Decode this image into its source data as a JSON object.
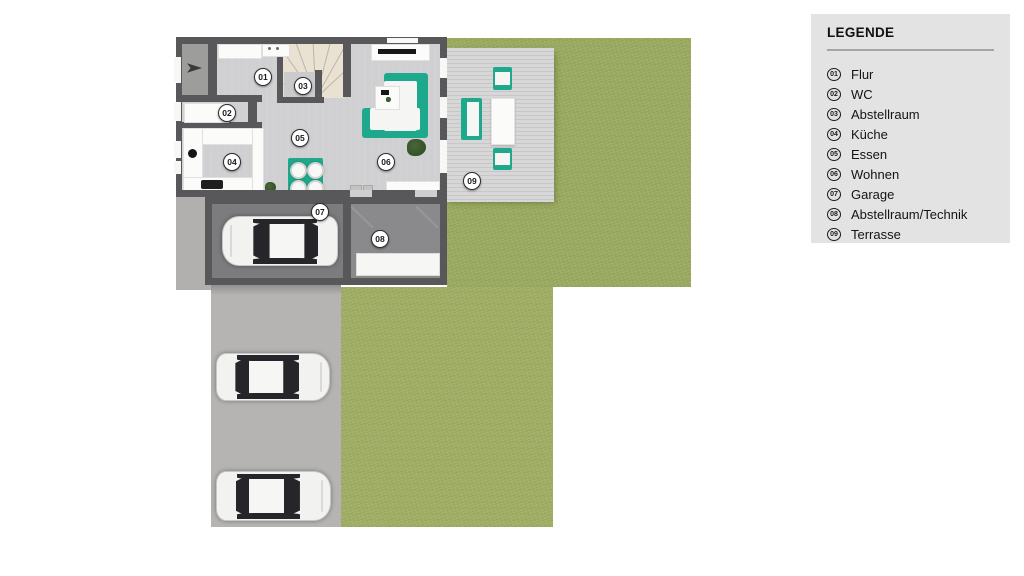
{
  "legend": {
    "title": "LEGENDE",
    "items": [
      {
        "num": "01",
        "label": "Flur"
      },
      {
        "num": "02",
        "label": "WC"
      },
      {
        "num": "03",
        "label": "Abstellraum"
      },
      {
        "num": "04",
        "label": "Küche"
      },
      {
        "num": "05",
        "label": "Essen"
      },
      {
        "num": "06",
        "label": "Wohnen"
      },
      {
        "num": "07",
        "label": "Garage"
      },
      {
        "num": "08",
        "label": "Abstellraum/Technik"
      },
      {
        "num": "09",
        "label": "Terrasse"
      }
    ]
  },
  "plan": {
    "markers": [
      {
        "num": "01",
        "x": 263,
        "y": 77
      },
      {
        "num": "02",
        "x": 227,
        "y": 113
      },
      {
        "num": "03",
        "x": 303,
        "y": 86
      },
      {
        "num": "04",
        "x": 232,
        "y": 162
      },
      {
        "num": "05",
        "x": 300,
        "y": 138
      },
      {
        "num": "06",
        "x": 386,
        "y": 162
      },
      {
        "num": "07",
        "x": 320,
        "y": 212
      },
      {
        "num": "08",
        "x": 380,
        "y": 239
      },
      {
        "num": "09",
        "x": 472,
        "y": 181
      }
    ]
  },
  "colors": {
    "accent_teal": "#1ea98c",
    "grass_green": "#9dac63",
    "wall_gray": "#58585a",
    "legend_bg": "#e3e3e3"
  }
}
